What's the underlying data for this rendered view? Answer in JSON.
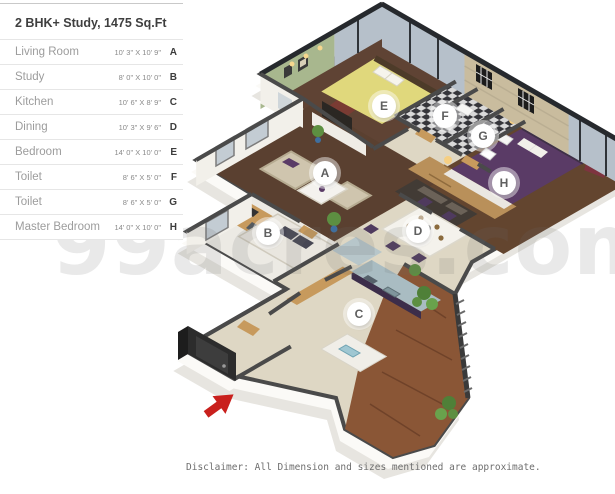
{
  "legend": {
    "title": "2 BHK+ Study, 1475 Sq.Ft",
    "rows": [
      {
        "name": "Living Room",
        "dim": "10' 3\" X 10' 9\"",
        "letter": "A"
      },
      {
        "name": "Study",
        "dim": "8' 0\" X 10' 0\"",
        "letter": "B"
      },
      {
        "name": "Kitchen",
        "dim": "10' 6\" X 8' 9\"",
        "letter": "C"
      },
      {
        "name": "Dining",
        "dim": "10' 3\" X 9' 6\"",
        "letter": "D"
      },
      {
        "name": "Bedroom",
        "dim": "14' 0\" X 10' 0\"",
        "letter": "E"
      },
      {
        "name": "Toilet",
        "dim": "8' 6\" X 5' 0\"",
        "letter": "F"
      },
      {
        "name": "Toilet",
        "dim": "8' 6\" X 5' 0\"",
        "letter": "G"
      },
      {
        "name": "Master Bedroom",
        "dim": "14' 0\" X 10' 0\"",
        "letter": "H"
      }
    ]
  },
  "plan": {
    "labels": [
      {
        "letter": "A",
        "room": "Living Room"
      },
      {
        "letter": "B",
        "room": "Study"
      },
      {
        "letter": "C",
        "room": "Kitchen"
      },
      {
        "letter": "D",
        "room": "Dining"
      },
      {
        "letter": "E",
        "room": "Bedroom"
      },
      {
        "letter": "F",
        "room": "Toilet"
      },
      {
        "letter": "G",
        "room": "Toilet"
      },
      {
        "letter": "H",
        "room": "Master Bedroom"
      }
    ],
    "entrance_marker": "red-arrow"
  },
  "watermark": "99acres.com",
  "disclaimer": "Disclaimer: All Dimension and sizes mentioned are approximate.",
  "palette": {
    "wall_top": "#4a4a4a",
    "wall_face": "#f2f0ea",
    "floor_hall": "#ded7c4",
    "floor_wood": "#5d4434",
    "floor_balcony": "#8a5636",
    "glass": "#b6c0ca",
    "green_wall": "#a8b78e",
    "tile_wall": "#c9bc9e",
    "bed_yellow": "#e0d87c",
    "bed_purple": "#5a3b66",
    "wood_furniture": "#c79a5d",
    "kitchen_cabinet": "#3c2d4a",
    "arrow_red": "#c9201d"
  }
}
